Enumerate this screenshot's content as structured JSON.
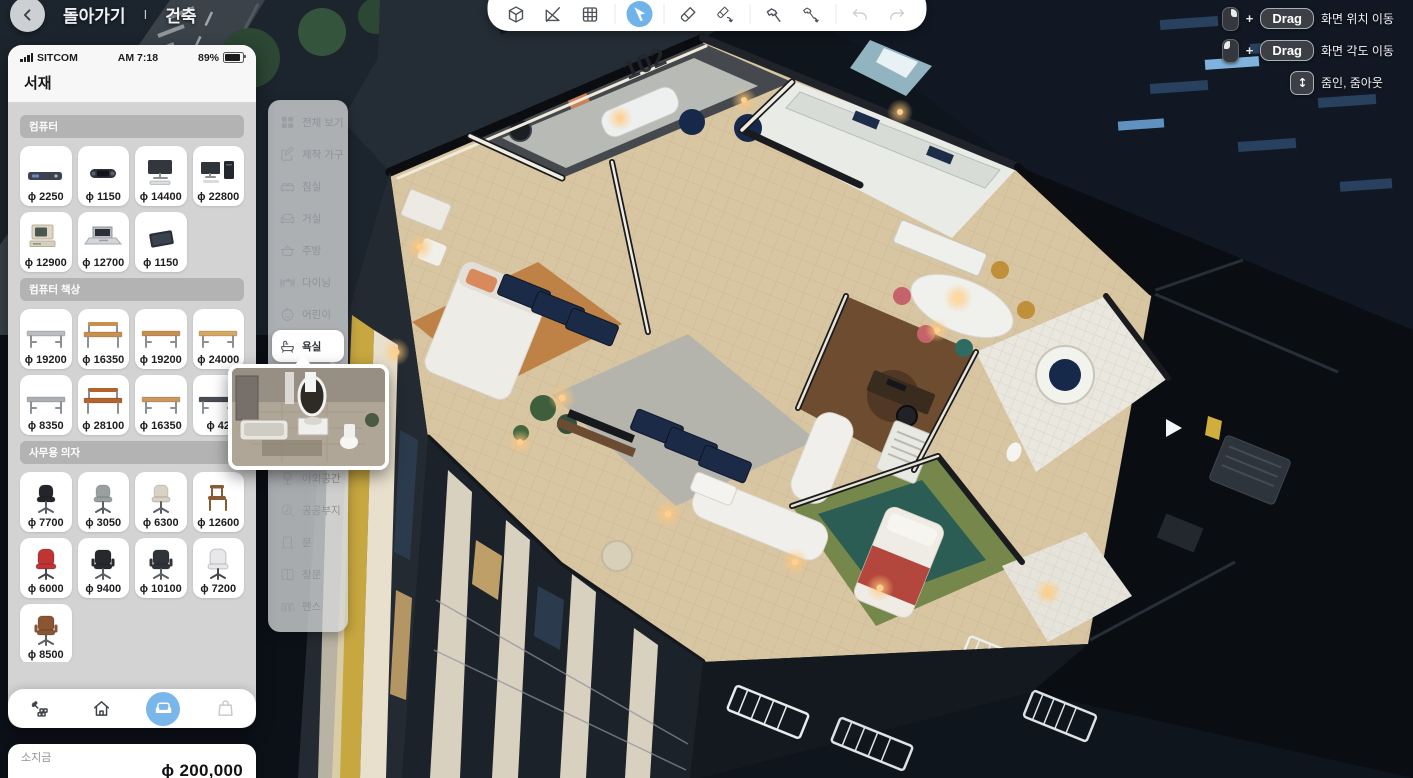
{
  "header": {
    "back_label": "돌아가기",
    "divider": "I",
    "mode_label": "건축"
  },
  "toolbar": {
    "tools": [
      {
        "name": "view-mode",
        "icon": "cube"
      },
      {
        "name": "measure",
        "icon": "measure"
      },
      {
        "name": "grid",
        "icon": "grid"
      },
      {
        "name": "select",
        "icon": "cursor",
        "selected": true
      },
      {
        "name": "paint",
        "icon": "brush"
      },
      {
        "name": "paint-repeat",
        "icon": "brush-redo"
      },
      {
        "name": "build",
        "icon": "hammer"
      },
      {
        "name": "build-repeat",
        "icon": "hammer-redo"
      },
      {
        "name": "undo",
        "icon": "undo",
        "disabled": true
      },
      {
        "name": "redo",
        "icon": "redo",
        "disabled": true
      }
    ]
  },
  "camera_help": {
    "rows": [
      {
        "mouse": "right",
        "plus": "+",
        "key": "Drag",
        "label": "화면 위치 이동"
      },
      {
        "mouse": "left",
        "plus": "+",
        "key": "Drag",
        "label": "화면 각도 이동"
      },
      {
        "icon": "scroll",
        "label": "줌인, 줌아웃"
      }
    ]
  },
  "phone": {
    "carrier": "SITCOM",
    "time": "AM 7:18",
    "battery": "89%",
    "title": "서재",
    "sections": [
      {
        "title": "컴퓨터",
        "items": [
          {
            "kind": "console",
            "color": "#3c4250",
            "price": "ɸ 2250"
          },
          {
            "kind": "handheld",
            "color": "#2e3138",
            "price": "ɸ 1150"
          },
          {
            "kind": "monitor",
            "color": "#33373d",
            "price": "ɸ 14400"
          },
          {
            "kind": "pc",
            "color": "#2f333a",
            "price": "ɸ 22800"
          },
          {
            "kind": "retro",
            "color": "#ddd6c4",
            "price": "ɸ 12900"
          },
          {
            "kind": "laptop",
            "color": "#c9cbcd",
            "price": "ɸ 12700"
          },
          {
            "kind": "tablet",
            "color": "#2c2f35",
            "price": "ɸ 1150"
          }
        ]
      },
      {
        "title": "컴퓨터 책상",
        "items": [
          {
            "kind": "desk",
            "color": "#b9bcc0",
            "price": "ɸ 19200"
          },
          {
            "kind": "deskhutch",
            "color": "#c98f4e",
            "price": "ɸ 16350"
          },
          {
            "kind": "desk",
            "color": "#c98f4e",
            "price": "ɸ 19200"
          },
          {
            "kind": "desk",
            "color": "#d7a85f",
            "price": "ɸ 24000"
          },
          {
            "kind": "desk",
            "color": "#aab0b4",
            "price": "ɸ 8350"
          },
          {
            "kind": "deskhutch",
            "color": "#b4622e",
            "price": "ɸ 28100"
          },
          {
            "kind": "desk",
            "color": "#c9995c",
            "price": "ɸ 16350"
          },
          {
            "kind": "desk",
            "color": "#4a4e54",
            "price": "ɸ 42"
          }
        ]
      },
      {
        "title": "사무용 의자",
        "items": [
          {
            "kind": "chair",
            "color": "#22252a",
            "price": "ɸ 7700"
          },
          {
            "kind": "chair",
            "color": "#9aa0a0",
            "price": "ɸ 3050"
          },
          {
            "kind": "chair",
            "color": "#d9d2c4",
            "price": "ɸ 6300"
          },
          {
            "kind": "chairwood",
            "color": "#8a5a30",
            "price": "ɸ 12600"
          },
          {
            "kind": "gaming",
            "color": "#c03434",
            "price": "ɸ 6000"
          },
          {
            "kind": "chairexec",
            "color": "#26282c",
            "price": "ɸ 9400"
          },
          {
            "kind": "chairexec",
            "color": "#303338",
            "price": "ɸ 10100"
          },
          {
            "kind": "gaming",
            "color": "#e8e8ea",
            "price": "ɸ 7200"
          },
          {
            "kind": "chairexec",
            "color": "#8a5632",
            "price": "ɸ 8500"
          }
        ]
      },
      {
        "title": "사무 가전",
        "items": [
          {
            "kind": "device",
            "color": "#cfd3d3",
            "price": ""
          },
          {
            "kind": "device",
            "color": "#c7cbcd",
            "price": ""
          },
          {
            "kind": "device",
            "color": "#d4d7d9",
            "price": ""
          },
          {
            "kind": "tripod",
            "color": "#9a9ea2",
            "price": ""
          }
        ]
      }
    ],
    "nav": [
      {
        "name": "terrain",
        "icon": "terrain"
      },
      {
        "name": "home",
        "icon": "home"
      },
      {
        "name": "furniture",
        "icon": "sofa-fill",
        "selected": true
      },
      {
        "name": "shop",
        "icon": "bag",
        "disabled": true
      }
    ]
  },
  "money": {
    "label": "소지금",
    "amount": "ɸ 200,000"
  },
  "category_menu": {
    "selected_index": 7,
    "items": [
      {
        "label": "전체 보기",
        "icon": "grid-all"
      },
      {
        "label": "제작 가구",
        "icon": "edit"
      },
      {
        "label": "침실",
        "icon": "bed"
      },
      {
        "label": "거실",
        "icon": "sofa"
      },
      {
        "label": "주방",
        "icon": "pot"
      },
      {
        "label": "다이닝",
        "icon": "dining"
      },
      {
        "label": "어린이",
        "icon": "kid"
      },
      {
        "label": "욕실",
        "icon": "bath"
      },
      {
        "label": "야외공간",
        "icon": "tree"
      },
      {
        "label": "공공부지",
        "icon": "search"
      },
      {
        "label": "문",
        "icon": "door"
      },
      {
        "label": "창문",
        "icon": "window"
      },
      {
        "label": "펜스",
        "icon": "fence"
      }
    ]
  },
  "scene": {
    "building_number": "102"
  },
  "colors": {
    "accent_blue": "#6FB3E8",
    "currency_symbol": "ɸ",
    "money_text": "#121316"
  }
}
